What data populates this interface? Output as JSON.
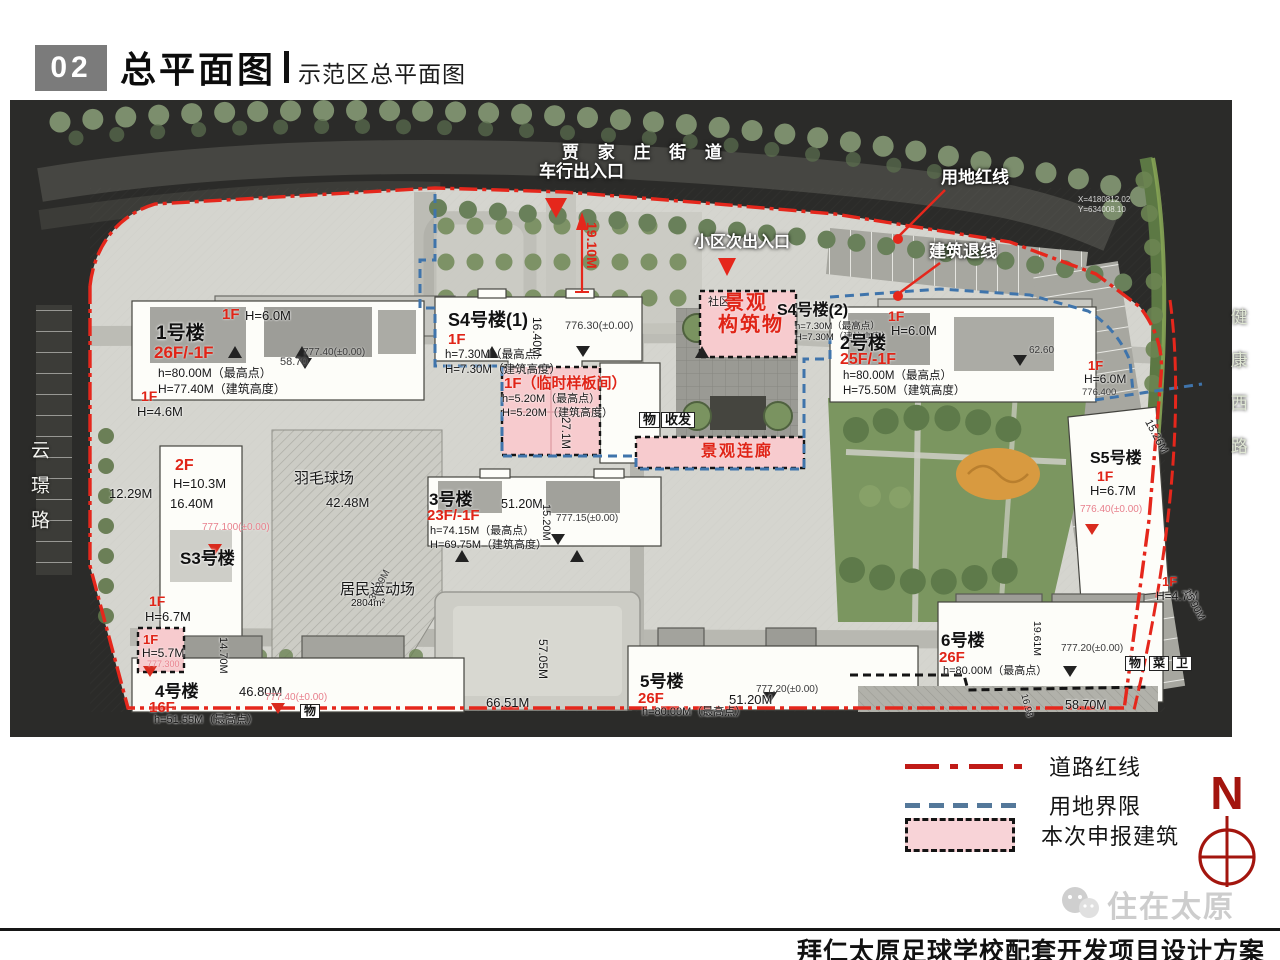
{
  "header": {
    "index": "02",
    "title": "总平面图",
    "subtitle": "示范区总平面图"
  },
  "legend": {
    "items": [
      {
        "label": "道路红线",
        "type": "red-dashdot",
        "color": "#c01b17"
      },
      {
        "label": "用地界限",
        "type": "blue-dashed",
        "color": "#54789a"
      },
      {
        "label": "本次申报建筑",
        "type": "pink-area",
        "color": "#f8d3d7"
      }
    ],
    "north": "N"
  },
  "footer": {
    "watermark": "住在太原",
    "project_title": "拜仁太原足球学校配套开发项目设计方案"
  },
  "colors": {
    "road_redline": "#e5271c",
    "land_boundary": "#3f74ab",
    "declared_building": "#f7cbce"
  },
  "map": {
    "annotations": [
      {
        "x": 562,
        "y": 144,
        "t": "贾 家 庄 街 道",
        "c": "w",
        "s": 17,
        "ls": 7,
        "n": "road-label-jiajiazhuang-street"
      },
      {
        "x": 539,
        "y": 163,
        "t": "车行出入口",
        "c": "w",
        "s": 17,
        "n": "callout-vehicle-entrance"
      },
      {
        "x": 941,
        "y": 169,
        "t": "用地红线",
        "c": "w",
        "s": 17,
        "n": "callout-land-redline"
      },
      {
        "x": 929,
        "y": 243,
        "t": "建筑退线",
        "c": "w",
        "s": 17,
        "n": "callout-building-setback"
      },
      {
        "x": 694,
        "y": 235,
        "t": "小区次出入口",
        "c": "w",
        "s": 16,
        "n": "callout-secondary-entrance"
      },
      {
        "x": 28,
        "y": 440,
        "t": "云璟路",
        "c": "road",
        "s": 19,
        "ls": 16,
        "n": "road-label-yunjing-road"
      },
      {
        "x": 1228,
        "y": 308,
        "t": "健康西路",
        "c": "road2",
        "s": 17,
        "ls": 26,
        "n": "road-label-jiankang-west-road"
      },
      {
        "x": 599,
        "y": 222,
        "t": "19.10M",
        "c": "redd",
        "s": 14,
        "r": 90
      },
      {
        "x": 222,
        "y": 307,
        "t": "1F",
        "c": "red",
        "s": 15
      },
      {
        "x": 245,
        "y": 309,
        "t": "H=6.0M",
        "c": "blk",
        "s": 13
      },
      {
        "x": 156,
        "y": 324,
        "t": "1号楼",
        "c": "blkb",
        "s": 19,
        "n": "building-label-1"
      },
      {
        "x": 154,
        "y": 344,
        "t": "26F/-1F",
        "c": "red",
        "s": 17
      },
      {
        "x": 158,
        "y": 367,
        "t": "h=80.00M（最高点）",
        "c": "blk",
        "s": 12
      },
      {
        "x": 158,
        "y": 383,
        "t": "H=77.40M（建筑高度）",
        "c": "blk",
        "s": 12
      },
      {
        "x": 280,
        "y": 357,
        "t": "58.70",
        "c": "dim",
        "s": 11
      },
      {
        "x": 303,
        "y": 348,
        "t": "777.40(±0.00)",
        "c": "dim",
        "s": 10
      },
      {
        "x": 141,
        "y": 389,
        "t": "1F",
        "c": "red",
        "s": 14
      },
      {
        "x": 137,
        "y": 405,
        "t": "H=4.6M",
        "c": "blk",
        "s": 13
      },
      {
        "x": 175,
        "y": 458,
        "t": "2F",
        "c": "red",
        "s": 16
      },
      {
        "x": 173,
        "y": 477,
        "t": "H=10.3M",
        "c": "blk",
        "s": 13
      },
      {
        "x": 170,
        "y": 497,
        "t": "16.40M",
        "c": "blk",
        "s": 13
      },
      {
        "x": 109,
        "y": 487,
        "t": "12.29M",
        "c": "blk",
        "s": 13
      },
      {
        "x": 202,
        "y": 523,
        "t": "777.100(±0.00)",
        "c": "pinkt",
        "s": 10
      },
      {
        "x": 180,
        "y": 550,
        "t": "S3号楼",
        "c": "blkb",
        "s": 17,
        "n": "building-label-s3"
      },
      {
        "x": 149,
        "y": 594,
        "t": "1F",
        "c": "red",
        "s": 14
      },
      {
        "x": 145,
        "y": 610,
        "t": "H=6.7M",
        "c": "blk",
        "s": 13
      },
      {
        "x": 143,
        "y": 633,
        "t": "1F",
        "c": "red",
        "s": 13
      },
      {
        "x": 142,
        "y": 647,
        "t": "H=5.7M",
        "c": "blk",
        "s": 12
      },
      {
        "x": 147,
        "y": 660,
        "t": "777.300",
        "c": "pinkt",
        "s": 9
      },
      {
        "x": 294,
        "y": 471,
        "t": "羽毛球场",
        "c": "blk",
        "s": 15,
        "n": "label-badminton-court"
      },
      {
        "x": 326,
        "y": 496,
        "t": "42.48M",
        "c": "blk",
        "s": 13
      },
      {
        "x": 340,
        "y": 582,
        "t": "居民运动场",
        "c": "blk",
        "s": 15,
        "n": "label-residents-field"
      },
      {
        "x": 351,
        "y": 599,
        "t": "2804m²",
        "c": "blk",
        "s": 10
      },
      {
        "x": 368,
        "y": 598,
        "t": "34.29M",
        "c": "dim",
        "s": 10,
        "r": -62
      },
      {
        "x": 448,
        "y": 311,
        "t": "S4号楼(1)",
        "c": "blkb",
        "s": 18,
        "n": "building-label-s4-1"
      },
      {
        "x": 448,
        "y": 332,
        "t": "1F",
        "c": "red",
        "s": 15
      },
      {
        "x": 445,
        "y": 349,
        "t": "h=7.30M（最高点）",
        "c": "blk",
        "s": 11.5
      },
      {
        "x": 445,
        "y": 364,
        "t": "H=7.30M（建筑高度）",
        "c": "blk",
        "s": 11.5
      },
      {
        "x": 543,
        "y": 317,
        "t": "16.40M",
        "c": "blk",
        "s": 12,
        "r": 90
      },
      {
        "x": 565,
        "y": 321,
        "t": "776.30(±0.00)",
        "c": "dim",
        "s": 11
      },
      {
        "x": 504,
        "y": 376,
        "t": "1F（临时样板间）",
        "c": "red",
        "s": 15,
        "n": "label-temporary-model-room"
      },
      {
        "x": 502,
        "y": 394,
        "t": "h=5.20M（最高点）",
        "c": "blk",
        "s": 11
      },
      {
        "x": 502,
        "y": 408,
        "t": "H=5.20M（建筑高度）",
        "c": "blk",
        "s": 11
      },
      {
        "x": 571,
        "y": 417,
        "t": "27.1M",
        "c": "blk",
        "s": 11.5,
        "r": 90
      },
      {
        "x": 639,
        "y": 412,
        "t": "物",
        "c": "box",
        "s": 13
      },
      {
        "x": 661,
        "y": 412,
        "t": "收发",
        "c": "box",
        "s": 13
      },
      {
        "x": 708,
        "y": 297,
        "t": "社区",
        "c": "blk",
        "s": 11
      },
      {
        "x": 724,
        "y": 293,
        "t": "景观",
        "c": "redL",
        "s": 20,
        "n": "label-landscape-structure"
      },
      {
        "x": 718,
        "y": 315,
        "t": "构筑物",
        "c": "redL",
        "s": 20
      },
      {
        "x": 777,
        "y": 303,
        "t": "S4号楼(2)",
        "c": "blkb",
        "s": 16,
        "n": "building-label-s4-2"
      },
      {
        "x": 795,
        "y": 322,
        "t": "h=7.30M（最高点）",
        "c": "blk",
        "s": 9.5
      },
      {
        "x": 795,
        "y": 333,
        "t": "H=7.30M（建筑高度）",
        "c": "blk",
        "s": 9.5
      },
      {
        "x": 701,
        "y": 444,
        "t": "景观连廊",
        "c": "redL",
        "s": 16,
        "n": "label-landscape-corridor"
      },
      {
        "x": 888,
        "y": 309,
        "t": "1F",
        "c": "red",
        "s": 14
      },
      {
        "x": 891,
        "y": 324,
        "t": "H=6.0M",
        "c": "blk",
        "s": 13
      },
      {
        "x": 840,
        "y": 334,
        "t": "2号楼",
        "c": "blkb",
        "s": 18,
        "n": "building-label-2"
      },
      {
        "x": 840,
        "y": 352,
        "t": "25F/-1F",
        "c": "red",
        "s": 16
      },
      {
        "x": 843,
        "y": 370,
        "t": "h=80.00M（最高点）",
        "c": "blk",
        "s": 11.5
      },
      {
        "x": 843,
        "y": 385,
        "t": "H=75.50M（建筑高度）",
        "c": "blk",
        "s": 11.5
      },
      {
        "x": 1029,
        "y": 346,
        "t": "62.60",
        "c": "dim",
        "s": 10
      },
      {
        "x": 1088,
        "y": 359,
        "t": "1F",
        "c": "red",
        "s": 13
      },
      {
        "x": 1084,
        "y": 373,
        "t": "H=6.0M",
        "c": "blk",
        "s": 12
      },
      {
        "x": 1082,
        "y": 388,
        "t": "776.400",
        "c": "dim",
        "s": 9.5
      },
      {
        "x": 1078,
        "y": 196,
        "t": "X=4180812.02",
        "c": "coord",
        "s": 8
      },
      {
        "x": 1078,
        "y": 206,
        "t": "Y=634008.10",
        "c": "coord",
        "s": 8
      },
      {
        "x": 1090,
        "y": 451,
        "t": "S5号楼",
        "c": "blkb",
        "s": 16,
        "n": "building-label-s5"
      },
      {
        "x": 1097,
        "y": 469,
        "t": "1F",
        "c": "red",
        "s": 14
      },
      {
        "x": 1090,
        "y": 484,
        "t": "H=6.7M",
        "c": "blk",
        "s": 13
      },
      {
        "x": 1080,
        "y": 505,
        "t": "776.40(±0.00)",
        "c": "pinkt",
        "s": 10
      },
      {
        "x": 1152,
        "y": 418,
        "t": "15.26M",
        "c": "blk",
        "s": 11,
        "r": 62
      },
      {
        "x": 1162,
        "y": 575,
        "t": "1F",
        "c": "red",
        "s": 13
      },
      {
        "x": 1156,
        "y": 590,
        "t": "H=4.7M",
        "c": "blk",
        "s": 12
      },
      {
        "x": 1190,
        "y": 588,
        "t": "15.90M",
        "c": "blk",
        "s": 10,
        "r": 62
      },
      {
        "x": 429,
        "y": 491,
        "t": "3号楼",
        "c": "blkb",
        "s": 17,
        "n": "building-label-3"
      },
      {
        "x": 427,
        "y": 508,
        "t": "23F/-1F",
        "c": "red",
        "s": 15
      },
      {
        "x": 430,
        "y": 526,
        "t": "h=74.15M（最高点）",
        "c": "blk",
        "s": 11
      },
      {
        "x": 430,
        "y": 540,
        "t": "H=69.75M（建筑高度）",
        "c": "blk",
        "s": 11
      },
      {
        "x": 501,
        "y": 498,
        "t": "51.20M",
        "c": "blk",
        "s": 12.5
      },
      {
        "x": 551,
        "y": 504,
        "t": "15.20M",
        "c": "blk",
        "s": 11,
        "r": 90
      },
      {
        "x": 556,
        "y": 514,
        "t": "777.15(±0.00)",
        "c": "dim",
        "s": 10
      },
      {
        "x": 155,
        "y": 683,
        "t": "4号楼",
        "c": "blkb",
        "s": 17,
        "n": "building-label-4"
      },
      {
        "x": 149,
        "y": 700,
        "t": "16F",
        "c": "red",
        "s": 15
      },
      {
        "x": 154,
        "y": 715,
        "t": "h=51.55M（最高点）",
        "c": "blk",
        "s": 11
      },
      {
        "x": 239,
        "y": 685,
        "t": "46.80M",
        "c": "blk",
        "s": 13
      },
      {
        "x": 265,
        "y": 693,
        "t": "777.40(±0.00)",
        "c": "pinkt",
        "s": 10
      },
      {
        "x": 300,
        "y": 704,
        "t": "物",
        "c": "box",
        "s": 12
      },
      {
        "x": 228,
        "y": 637,
        "t": "14.70M",
        "c": "blk",
        "s": 11,
        "r": 90
      },
      {
        "x": 640,
        "y": 673,
        "t": "5号楼",
        "c": "blkb",
        "s": 17,
        "n": "building-label-5"
      },
      {
        "x": 638,
        "y": 691,
        "t": "26F",
        "c": "red",
        "s": 15
      },
      {
        "x": 642,
        "y": 707,
        "t": "h=80.00M（最高点）",
        "c": "blk",
        "s": 11
      },
      {
        "x": 729,
        "y": 693,
        "t": "51.20M",
        "c": "blk",
        "s": 13
      },
      {
        "x": 756,
        "y": 685,
        "t": "777.20(±0.00)",
        "c": "dim",
        "s": 10
      },
      {
        "x": 549,
        "y": 639,
        "t": "57.05M",
        "c": "blk",
        "s": 12,
        "r": 90
      },
      {
        "x": 486,
        "y": 696,
        "t": "66.51M",
        "c": "blk",
        "s": 13
      },
      {
        "x": 941,
        "y": 632,
        "t": "6号楼",
        "c": "blkb",
        "s": 17,
        "n": "building-label-6"
      },
      {
        "x": 939,
        "y": 650,
        "t": "26F",
        "c": "red",
        "s": 15
      },
      {
        "x": 943,
        "y": 666,
        "t": "h=80.00M（最高点）",
        "c": "blk",
        "s": 11
      },
      {
        "x": 1061,
        "y": 644,
        "t": "777.20(±0.00)",
        "c": "dim",
        "s": 10
      },
      {
        "x": 1125,
        "y": 656,
        "t": "物",
        "c": "box",
        "s": 12
      },
      {
        "x": 1149,
        "y": 656,
        "t": "菜",
        "c": "box",
        "s": 12
      },
      {
        "x": 1172,
        "y": 656,
        "t": "卫",
        "c": "box",
        "s": 12
      },
      {
        "x": 1042,
        "y": 621,
        "t": "19.61M",
        "c": "blk",
        "s": 10.5,
        "r": 90
      },
      {
        "x": 1065,
        "y": 699,
        "t": "58.70M",
        "c": "blk",
        "s": 12.5
      },
      {
        "x": 1028,
        "y": 693,
        "t": "16.98",
        "c": "blk",
        "s": 9.5,
        "r": 75
      }
    ]
  }
}
